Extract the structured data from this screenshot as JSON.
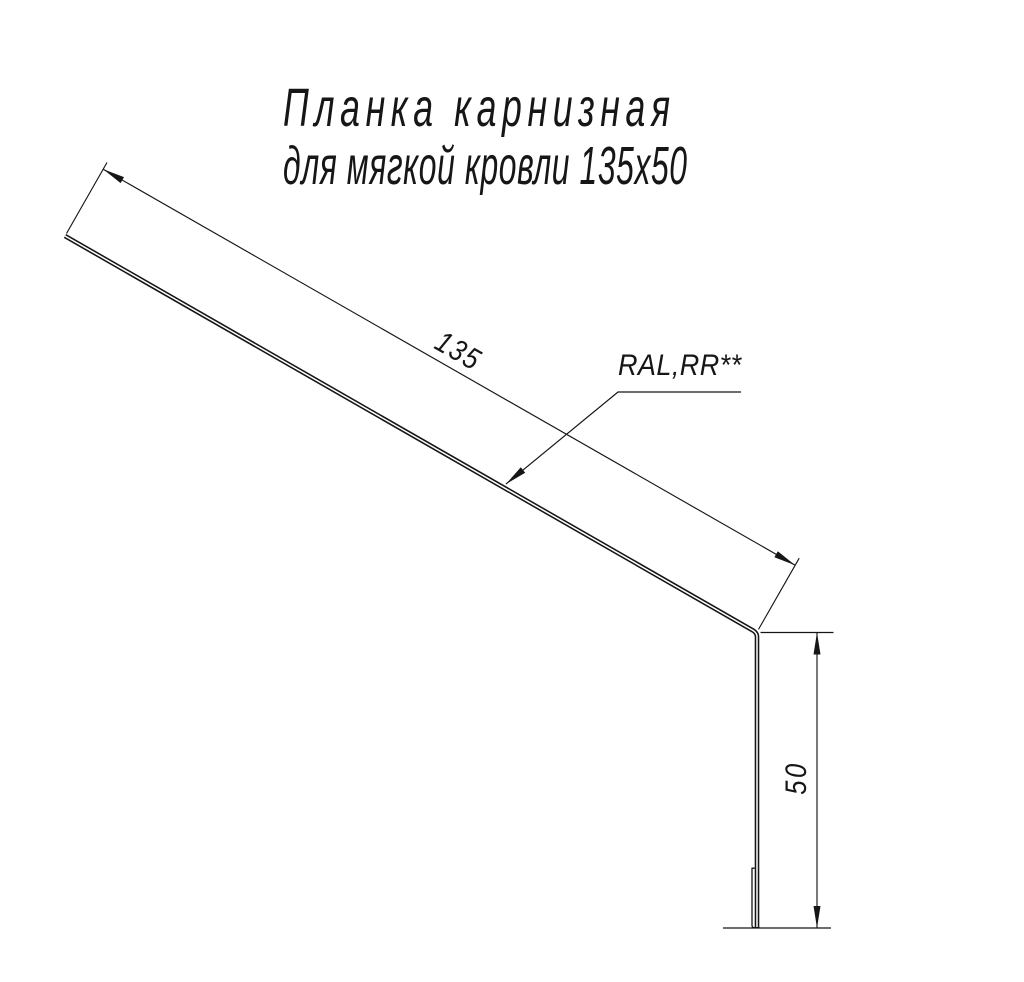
{
  "title": {
    "line1": "Планка карнизная",
    "line2": "для мягкой кровли 135х50"
  },
  "drawing": {
    "part": "eaves-strip-profile",
    "dimensions": {
      "flange_length": {
        "value": "135"
      },
      "flange_height": {
        "value": "50"
      }
    },
    "labels": {
      "coating": "RAL,RR**"
    }
  },
  "colors": {
    "ink": "#161616",
    "background": "#ffffff"
  }
}
